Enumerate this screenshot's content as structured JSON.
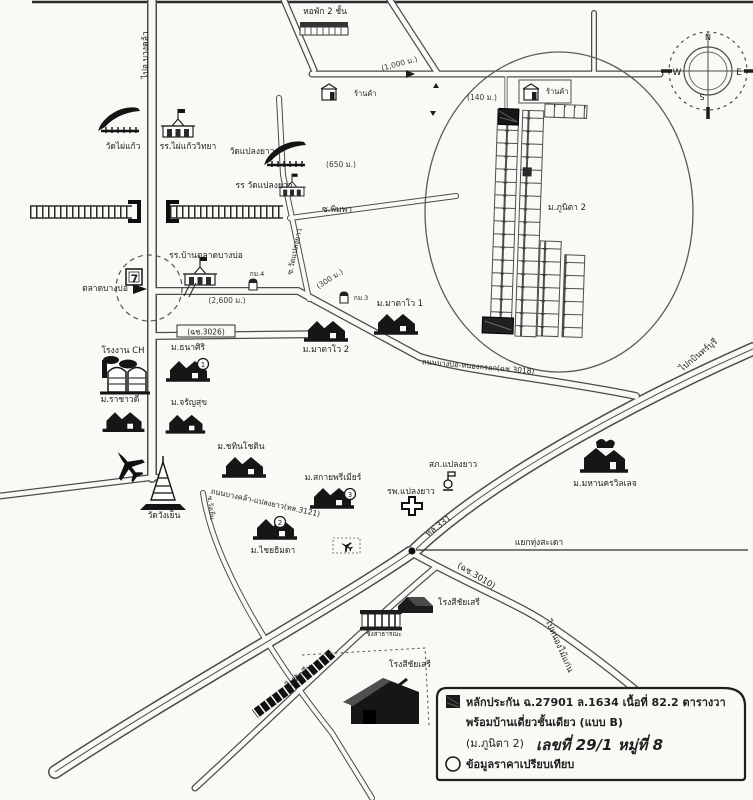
{
  "colors": {
    "ink": "#1f1f1f",
    "paper": "#f9f9f6",
    "subject_lot_fill": "#161616"
  },
  "compass": {
    "n": "N",
    "e": "E",
    "s": "S",
    "w": "W"
  },
  "labels": {
    "to_bang_khla": "ไปอ.บางคล้า",
    "dorm": "หอพัก 2 ชั้น",
    "shop1": "ร้านค้า",
    "shop2": "ร้านค้า",
    "dist_1000": "(1,000 ม.)",
    "dist_140": "(140 ม.)",
    "dist_650": "(650 ม.)",
    "dist_300": "(300 ม.)",
    "dist_2600": "(2,600 ม.)",
    "wat_phai_kaew": "วัดไผ่แก้ว",
    "school_phai_kaew": "รร.ไผ่แก้ววิทยา",
    "wat_plaeng_yao": "วัดแปลงยาว",
    "school_wat_plaeng_yao": "รร วัดแปลงยาว",
    "soi_phimpha": "ซ.พิมพา",
    "soi_wat_plaeng_yao": "ซ.วัดแปลงยาว",
    "km4": "กม.4",
    "km3": "กม.3",
    "school_ban_talad": "รร.บ้านตลาดบางบ่อ",
    "talad_bang_bo": "ตลาดบางบ่อ",
    "seven": "7",
    "route_3026": "(ฉช.3026)",
    "phunita2": "ม.ภูนิตา 2",
    "matavo1": "ม.มาตาโว 1",
    "matavo2": "ม.มาตาโว 2",
    "road_3018": "ถนนบางบ่อ-หนองกรอก(ฉช.3018)",
    "to_kabin_buri": "ไปกบินทร์บุรี",
    "factory_ch": "โรงงาน CH",
    "thanasiri": "ม.ธนาศิริ",
    "marker1": "1",
    "rachawadee": "ม.ราชาวดี",
    "jaransuk": "ม.จรัญสุข",
    "chatinchotin": "ม.ชทินโชติน",
    "sky_premier": "ม.สกายพรีเมียร์",
    "marker3": "3",
    "chaiyathimada": "ม.ไชยธิมดา",
    "marker2": "2",
    "road_3121": "ถนนบางคล้า-แปลงยาว(ทล.3121)",
    "wat_wang_yen": "วัดวังเย็น",
    "soi_wang_yen": "ซ.วังเย็น",
    "police": "สภ.แปลงยาว",
    "hospital": "รพ.แปลงยาว",
    "mahanakorn": "ม.มหานครวิลเลจ",
    "hw331": "ทล.331",
    "thung_sadao": "แยกทุ่งสะเดา",
    "route_3010": "(ฉช.3010)",
    "to_nong_mai_kaen": "ไปหนองไม้แก่น",
    "to_sattahip": "ไปสัตหีบ",
    "rice_mill1": "โรงสีชัยเสรี",
    "weighbridge": "ชั่งสาธารณะ",
    "rice_mill2": "โรงสีชัยเสรี"
  },
  "legend": {
    "line1": "หลักประกัน ฉ.27901 ล.1634 เนื้อที่ 82.2 ตารางวา",
    "line2": "พร้อมบ้านเดี่ยวชั้นเดียว (แบบ B)",
    "line3_prefix": "(ม.ภูนิตา 2)",
    "line3_handwritten": "เลขที่ 29/1 หมู่ที่ 8",
    "line4": "ข้อมูลราคาเปรียบเทียบ"
  }
}
